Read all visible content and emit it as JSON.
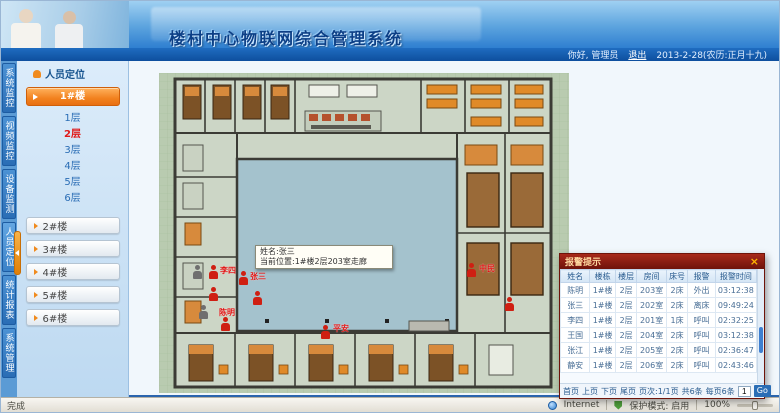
{
  "header": {
    "title": "楼村中心物联网综合管理系统",
    "greeting": "你好, 管理员",
    "logout": "退出",
    "date": "2013-2-28(农历:正月十九)"
  },
  "nav_tabs": [
    "系统监控",
    "视频监控",
    "设备监测",
    "人员定位",
    "统计报表",
    "系统管理"
  ],
  "sidebar": {
    "panel_title": "人员定位",
    "active_building": "1#楼",
    "floors": [
      "1层",
      "2层",
      "3层",
      "4层",
      "5层",
      "6层"
    ],
    "selected_floor": "2层",
    "other_buildings": [
      "2#楼",
      "3#楼",
      "4#楼",
      "5#楼",
      "6#楼"
    ]
  },
  "map": {
    "tooltip": {
      "line1": "姓名:张三",
      "line2": "当前位置:1#楼2层203室走廊"
    },
    "markers": [
      {
        "label": "李四"
      },
      {
        "label": "张三"
      },
      {
        "label": "陈明"
      },
      {
        "label": "平安"
      },
      {
        "label": "中民"
      }
    ]
  },
  "popup": {
    "title": "报警提示",
    "columns": [
      "姓名",
      "楼栋",
      "楼层",
      "房间",
      "床号",
      "报警",
      "报警时间"
    ],
    "rows": [
      [
        "陈明",
        "1#楼",
        "2层",
        "203室",
        "2床",
        "外出",
        "03:12:38"
      ],
      [
        "张三",
        "1#楼",
        "2层",
        "202室",
        "2床",
        "离床",
        "09:49:24"
      ],
      [
        "李四",
        "1#楼",
        "2层",
        "201室",
        "1床",
        "呼叫",
        "02:32:25"
      ],
      [
        "王国",
        "1#楼",
        "2层",
        "204室",
        "2床",
        "呼叫",
        "03:12:38"
      ],
      [
        "张江",
        "1#楼",
        "2层",
        "205室",
        "2床",
        "呼叫",
        "02:36:47"
      ],
      [
        "静安",
        "1#楼",
        "2层",
        "206室",
        "2床",
        "呼叫",
        "02:43:46"
      ]
    ],
    "pagination": {
      "first": "首页",
      "prev": "上页",
      "next": "下页",
      "last": "尾页",
      "info": "页次:1/1页",
      "total": "共6条",
      "per_page": "每页6条",
      "page_value": "1",
      "go": "Go"
    }
  },
  "statusbar": {
    "done": "完成",
    "zone": "Internet",
    "protected_mode": "保护模式: 启用",
    "zoom": "100%"
  },
  "colors": {
    "accent_orange": "#f08a1d",
    "alarm_red": "#8e2012",
    "header_blue": "#2f7fd0",
    "selected_red": "#e01b1b"
  }
}
